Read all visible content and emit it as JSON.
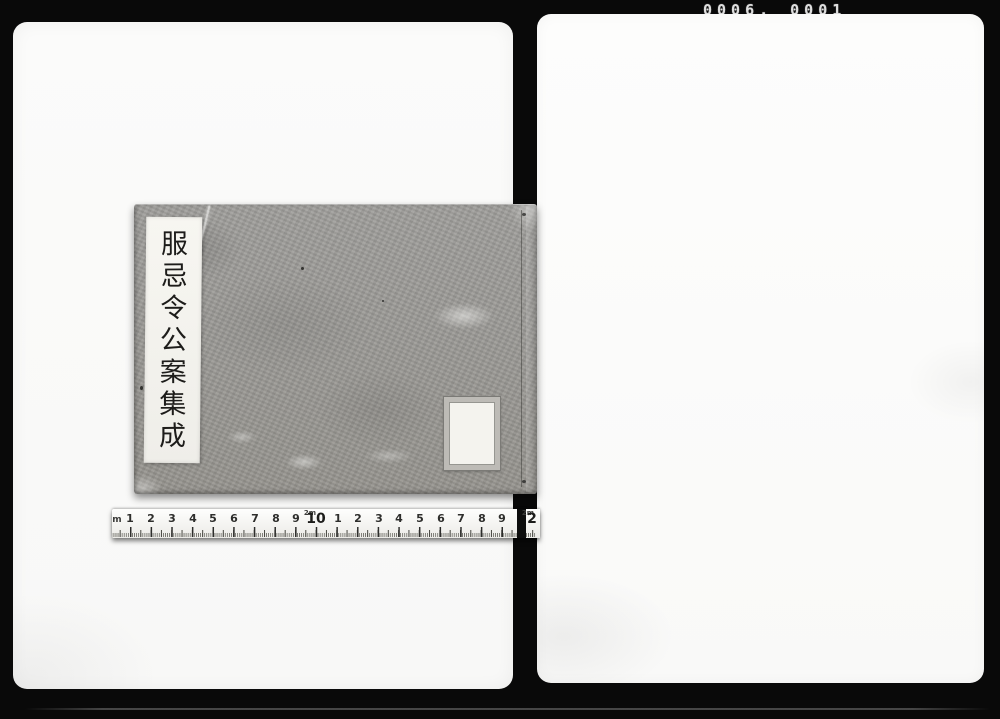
{
  "photo": {
    "film_counter": {
      "reel": "0006.",
      "frame": "0001"
    },
    "book": {
      "title": "服忌令公案集成",
      "title_chars": [
        "服",
        "忌",
        "令",
        "公",
        "案",
        "集",
        "成"
      ],
      "cover_color": "#9b9a96",
      "title_label_color": "#f6f5f0",
      "paste_label_text": ""
    },
    "ruler": {
      "unit_prefix": "m",
      "numbers": [
        "1",
        "2",
        "3",
        "4",
        "5",
        "6",
        "7",
        "8",
        "9",
        "10",
        "1",
        "2",
        "3",
        "4",
        "5",
        "6",
        "7",
        "8",
        "9",
        "2"
      ],
      "meter_marks": [
        "2m",
        "2m"
      ]
    },
    "colors": {
      "background": "#090909",
      "page": "#fbfbfa",
      "tape": "#f6f5f2",
      "counter_text": "#dedede"
    }
  }
}
